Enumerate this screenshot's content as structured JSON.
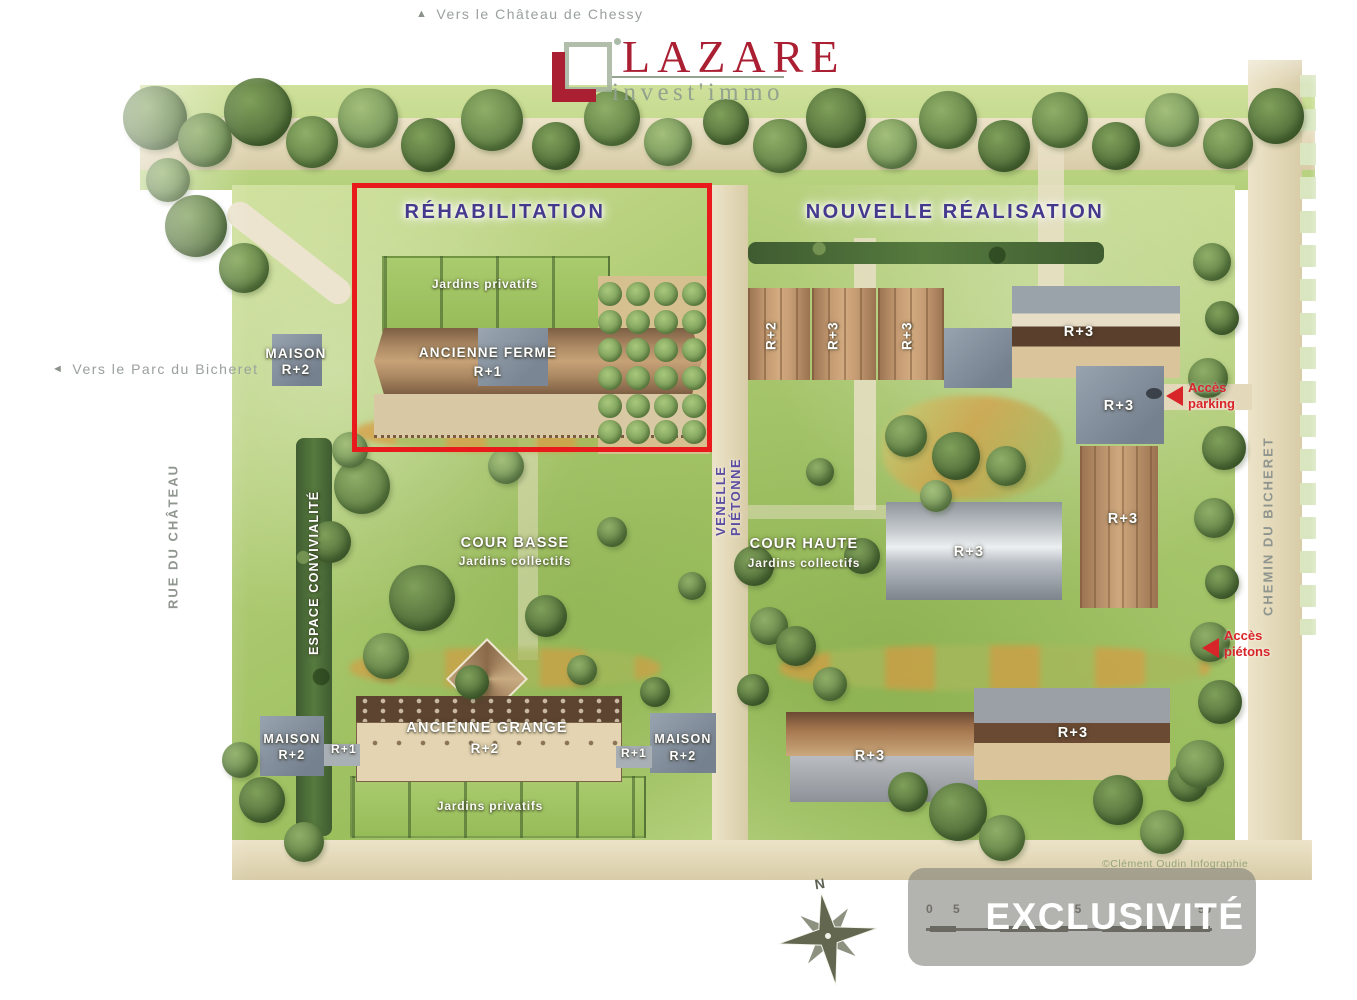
{
  "logo": {
    "brand": "LAZARE",
    "tagline": "invest'immo"
  },
  "directions": {
    "north_arrow": "▲",
    "north_text": "Vers le Château de Chessy",
    "west_arrow": "◄",
    "west_text": "Vers le Parc du Bicheret"
  },
  "headings": {
    "rehabilitation": "RÉHABILITATION",
    "nouvelle_realisation": "NOUVELLE RÉALISATION"
  },
  "streets": {
    "rue_du_chateau": "RUE DU CHÂTEAU",
    "venelle_pietonne": "VENELLE PIÉTONNE",
    "chemin_du_bicheret": "CHEMIN DU BICHERET"
  },
  "areas": {
    "jardins_privatifs_nord": "Jardins privatifs",
    "jardins_privatifs_sud": "Jardins privatifs",
    "cour_basse": "COUR BASSE",
    "cour_basse_sub": "Jardins collectifs",
    "cour_haute": "COUR HAUTE",
    "cour_haute_sub": "Jardins collectifs",
    "espace_convivialite": "ESPACE CONVIVIALITÉ"
  },
  "buildings": {
    "ancienne_ferme": {
      "name": "ANCIENNE FERME",
      "level": "R+1"
    },
    "ancienne_grange": {
      "name": "ANCIENNE GRANGE",
      "level": "R+2"
    },
    "maison_nord": {
      "name": "MAISON",
      "level": "R+2"
    },
    "maison_sud_ouest": {
      "name": "MAISON",
      "level": "R+2"
    },
    "maison_sud_est": {
      "name": "MAISON",
      "level": "R+2"
    },
    "aile_ouest_level": "R+1",
    "aile_est_level": "R+1",
    "rowhouses": [
      "R+2",
      "R+3",
      "R+3"
    ],
    "collectif_nord": "R+3",
    "collectif_carre": "R+3",
    "collectif_est": "R+3",
    "collectif_centre": "R+3",
    "collectif_sud_ouest": "R+3",
    "collectif_sud_est": "R+3"
  },
  "access": {
    "parking": {
      "line1": "Accès",
      "line2": "parking"
    },
    "pietons": {
      "line1": "Accès",
      "line2": "piétons"
    }
  },
  "compass": {
    "north_label": "N"
  },
  "scale_bar": {
    "ticks": [
      "0",
      "5",
      "25",
      "50"
    ]
  },
  "badge": {
    "label": "EXCLUSIVITÉ"
  },
  "credit": "©Clément Oudin Infographie",
  "colors": {
    "accent_red": "#e81a1c",
    "heading_purple": "#45398e",
    "logo_red": "#ab1f33",
    "logo_green": "#93a38f",
    "access_red": "#d8252a",
    "street_gray": "#8f958f"
  }
}
